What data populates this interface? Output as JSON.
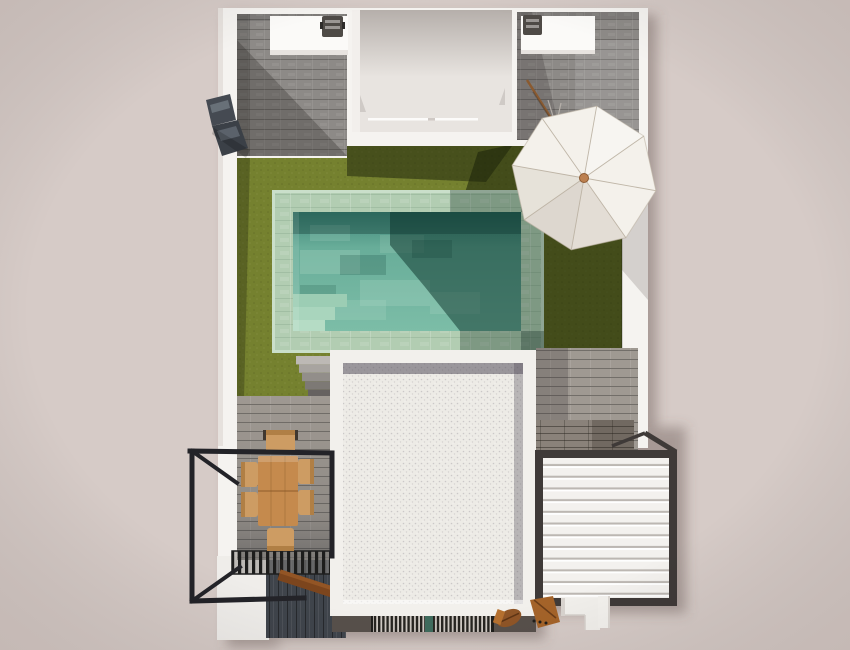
{
  "meta": {
    "title": "Top-down 3D architectural rendering of a villa plot",
    "canvas": {
      "width": 850,
      "height": 650
    }
  },
  "scene": {
    "description": "Photorealistic bird's-eye 3D render: white-walled villa plot with two stone-tiled patios and barbecue counters at top, central white lightwell courtyard, olive-green lawn, rectangular pool with mint stone coping and corner steps, white octagonal parasol casting a diagonal shadow, garden stairs, a white gravel flat roof with parapet, a white louvered pergola in a dark frame, a wooden six-seat dining set inside a black metal balcony railing, black slatted canopy, dark wood deck, floor vent grate and scattered wooden boards",
    "objects": [
      {
        "name": "ground-background",
        "label": "Pink-beige ground plane"
      },
      {
        "name": "perimeter-walls",
        "label": "White perimeter walls"
      },
      {
        "name": "left-patio",
        "label": "Grey stone tile patio (top-left)"
      },
      {
        "name": "left-bbq-counter",
        "label": "White counter with barbecue grill"
      },
      {
        "name": "central-lightwell",
        "label": "White courtyard lightwell with glass door line"
      },
      {
        "name": "right-patio",
        "label": "Grey stone tile patio (top-right)"
      },
      {
        "name": "right-bbq-counter",
        "label": "White counter with barbecue grill"
      },
      {
        "name": "corner-bench",
        "label": "Dark angled corner bench against left wall"
      },
      {
        "name": "lawn",
        "label": "Olive green lawn"
      },
      {
        "name": "pool",
        "label": "Rectangular pool, mint coping, corner steps"
      },
      {
        "name": "parasol",
        "label": "White octagonal parasol with wooden hub"
      },
      {
        "name": "garden-stairs",
        "label": "Stone steps from lawn down to terrace"
      },
      {
        "name": "flat-roof",
        "label": "White gravel flat roof with parapet"
      },
      {
        "name": "louvered-pergola",
        "label": "White louver roof in dark frame (bottom-right)"
      },
      {
        "name": "dining-set",
        "label": "Wooden dining table with six chairs"
      },
      {
        "name": "balcony-railing",
        "label": "Black metal railing frame (bottom-left)"
      },
      {
        "name": "slatted-canopy",
        "label": "Black slatted canopy strip"
      },
      {
        "name": "dark-deck",
        "label": "Dark wood deck boards"
      },
      {
        "name": "vent-grate",
        "label": "Dark floor ventilation grate"
      },
      {
        "name": "wood-props",
        "label": "Wooden boards / bench pieces at bottom"
      },
      {
        "name": "white-steps",
        "label": "Small white exterior steps (bottom-right)"
      }
    ]
  },
  "palette": {
    "background": "#d6cbc7",
    "wall_white": "#f5f3f0",
    "wall_edge": "#e6e1dd",
    "tile_base": "#8d8a87",
    "tile_joint": "#6e6b68",
    "counter_white": "#fbfaf8",
    "grill_dark": "#4e4a46",
    "lightwell": "#e8e4e0",
    "grass": "#75812f",
    "pool_coping": "#b2cdb2",
    "water_top": "#3d8577",
    "water_mid": "#68ad99",
    "water_low": "#7cbda7",
    "roof_white": "#f2f0ec",
    "roof_field": "#edebe6",
    "louver_white": "#f3f1ee",
    "louver_gap": "#bcb7b2",
    "frame_dark": "#3f3a38",
    "metal_black": "#232328",
    "deck_gray": "#9f9992",
    "deck_dark": "#3f444b",
    "stone_band": "#8a827a",
    "slat_dark": "#1d1d1c",
    "grate_dark": "#262420",
    "wood_table": "#c58a4d",
    "wood_chair": "#cd9c63",
    "wood_dark": "#7c451d",
    "umbrella": "#f4f1eb",
    "umbrella_hub": "#bc8050"
  }
}
